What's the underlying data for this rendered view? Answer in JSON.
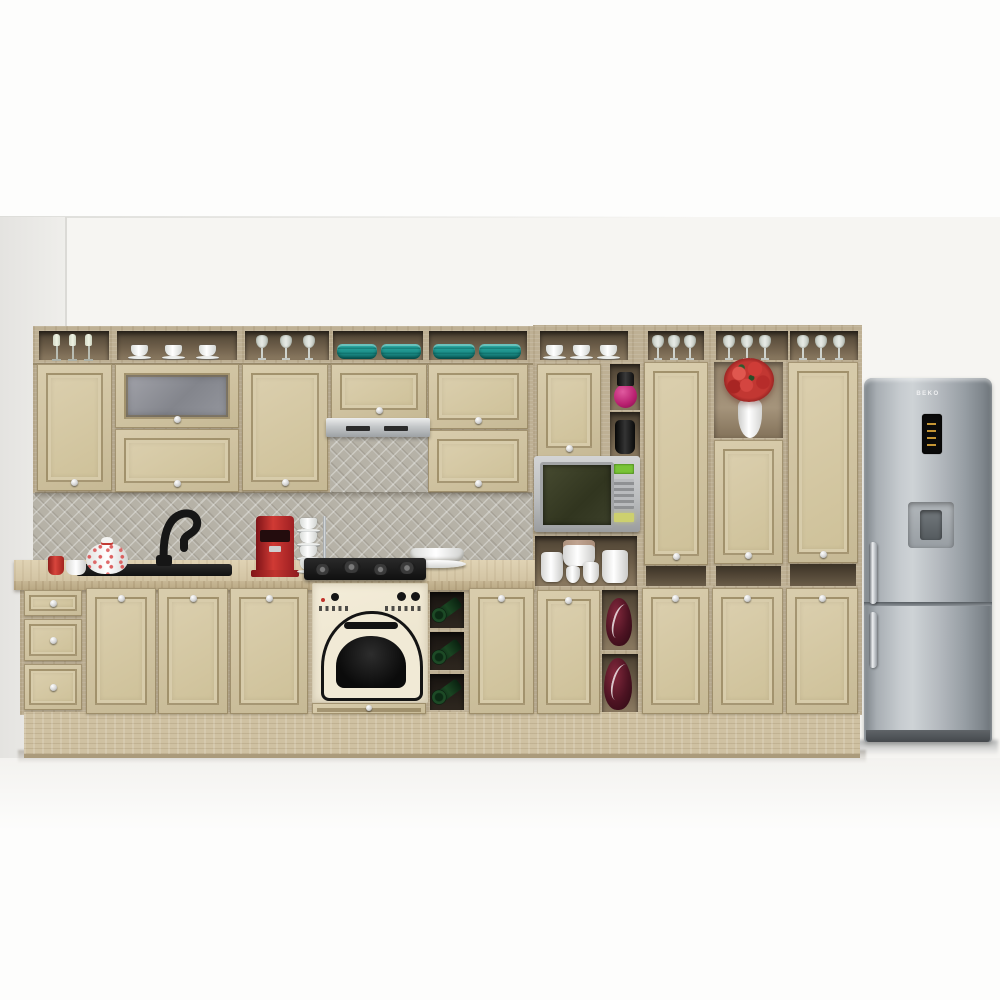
{
  "meta": {
    "type": "3D product render",
    "subject": "Classic beige kitchen cabinet set with built-in appliances and stainless refrigerator",
    "background": "white studio wall and floor"
  },
  "palette": {
    "cabinet_door": "#d1c4a2",
    "cabinet_frame": "#8a7a57",
    "carcass_wood": "#beb094",
    "shelf_interior": "#5f5140",
    "countertop": "#d8cbac",
    "plinth": "#cfc1a2",
    "backsplash_tile": "#b6b2a7",
    "teal_bowls": "#1b8d87",
    "red_accent": "#c0392f",
    "magenta_vase": "#c52a7d",
    "maroon_vase": "#4d1322",
    "wine_bottle_green": "#1a4522",
    "oven_cream": "#f1ead6",
    "appliance_black": "#141414",
    "stainless": "#b9bec3",
    "wall": "#f6f5f2",
    "floor": "#fcfcfb"
  },
  "upper_row": {
    "open_shelf_contents": [
      "three pale candlesticks",
      "three white cups with saucers",
      "three stemmed glasses",
      "stacked teal bowls",
      "stacked teal bowls"
    ],
    "cabinets": [
      "single door",
      "frosted-glass flip door over solid flip door",
      "single door",
      "flip door above range hood",
      "two stacked flip doors"
    ]
  },
  "tall_section": {
    "top_shelf_contents": [
      "three patterned cups",
      "wine glasses",
      "wine glasses",
      "wine glasses"
    ],
    "columns": [
      "door over microwave niche over open shelf with white canisters over base door",
      "narrow cubbies with magenta vase and black jar, maroon vases below",
      "tall door with base door",
      "open cubby with red bouquet in white vase, mid door, open gap, base door",
      "tall door with base door"
    ]
  },
  "appliances": {
    "range_hood": {
      "finish": "slim stainless under-cabinet hood"
    },
    "hob": {
      "type": "black 4-burner gas hob"
    },
    "oven": {
      "style": "retro built-in",
      "color": "cream with black arched window and knobs"
    },
    "microwave": {
      "finish": "silver",
      "display_color": "#8ddc46"
    },
    "coffee_machine": {
      "color": "red espresso machine"
    },
    "refrigerator": {
      "brand": "BEKO",
      "config": "bottom freezer",
      "features": [
        "black top display",
        "recessed water dispenser",
        "two chrome handles"
      ],
      "finish": "stainless"
    }
  },
  "counter_items": [
    "red cup",
    "white mug",
    "white teapot with red pattern",
    "black swan-neck faucet",
    "black inset sink",
    "stack of four white cups on chrome stand",
    "white bowl on plate"
  ],
  "base_row": [
    "three-drawer unit",
    "two sink doors",
    "single door",
    "oven housing with drawer",
    "wine rack with three green bottles",
    "single door",
    "door under microwave",
    "two maroon vases in open cubbies",
    "three tall-unit base doors"
  ]
}
